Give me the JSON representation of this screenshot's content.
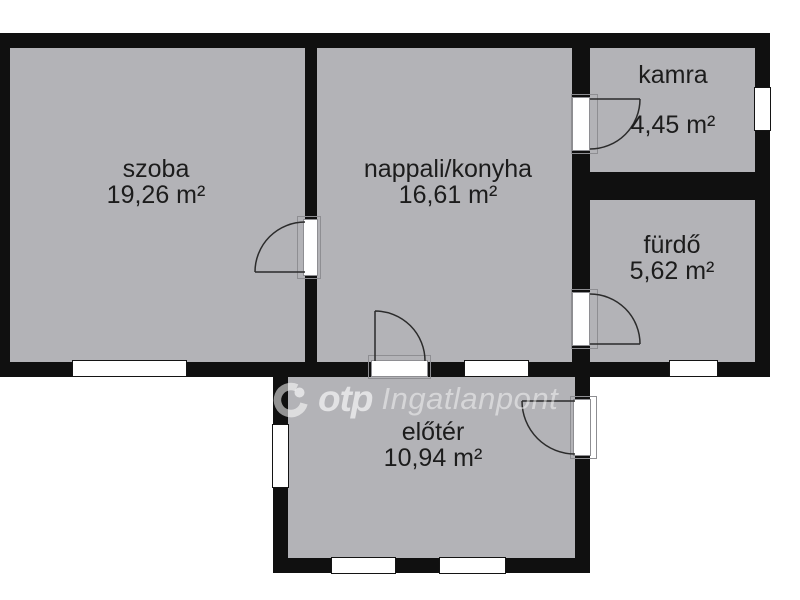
{
  "colors": {
    "wall": "#101010",
    "room": "#b3b3b7",
    "background": "#ffffff",
    "label": "#1c1c1c"
  },
  "rooms": {
    "szoba": {
      "name": "szoba",
      "area": "19,26 m²"
    },
    "nappali": {
      "name": "nappali/konyha",
      "area": "16,61 m²"
    },
    "kamra": {
      "name": "kamra",
      "area": "4,45 m²"
    },
    "furdo": {
      "name": "fürdő",
      "area": "5,62 m²"
    },
    "eloter": {
      "name": "előtér",
      "area": "10,94 m²"
    }
  },
  "watermark": {
    "brand": "otp",
    "text": "Ingatlanpont"
  }
}
